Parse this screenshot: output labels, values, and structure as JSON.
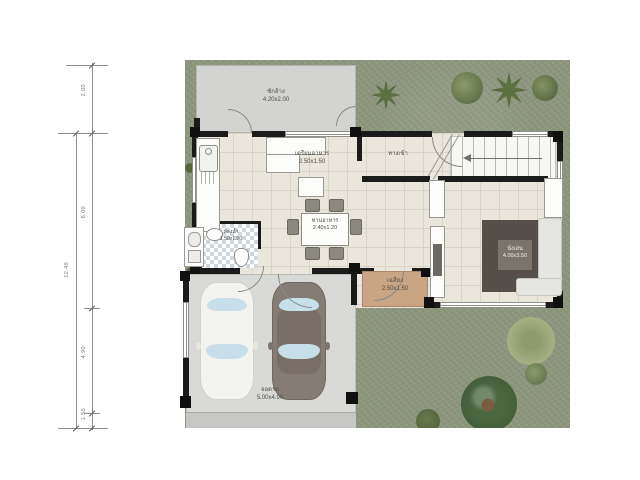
{
  "rooms": {
    "laundry": {
      "label": "ซักล้าง",
      "size": "4.20x2.00"
    },
    "kitchen": {
      "label": "เตรียมอาหาร",
      "size": "2.50x1.50"
    },
    "entry": {
      "label": "ทางเข้า"
    },
    "dining": {
      "label": "ทานอาหาร",
      "size": "2.40x1.20"
    },
    "living": {
      "label": "นั่งเล่น",
      "size": "4.00x3.50"
    },
    "bathroom": {
      "label": "ห้องน้ำ",
      "size": "1.50x1.90"
    },
    "porch": {
      "label": "เฉลียง",
      "size": "2.50x1.50"
    },
    "carpark": {
      "label": "จอดรถ",
      "size": "5.00x4.90"
    }
  },
  "dimensions": {
    "overall": "12.40",
    "segments": [
      "2.00",
      "6.00",
      "4.90",
      "1.50"
    ]
  },
  "colors": {
    "grass": "#8e977e",
    "laundry_floor": "#d3d3d1",
    "main_floor": "#eae6dc",
    "garage_floor": "#d9d9d7",
    "driveway": "#c6c6c4",
    "porch": "#c9a584",
    "rug": "#564f49",
    "wall": "#1b1b1b",
    "white_car": "#f3f3ef",
    "gray_car": "#857d75",
    "window_glass": "#c7dfe9"
  }
}
